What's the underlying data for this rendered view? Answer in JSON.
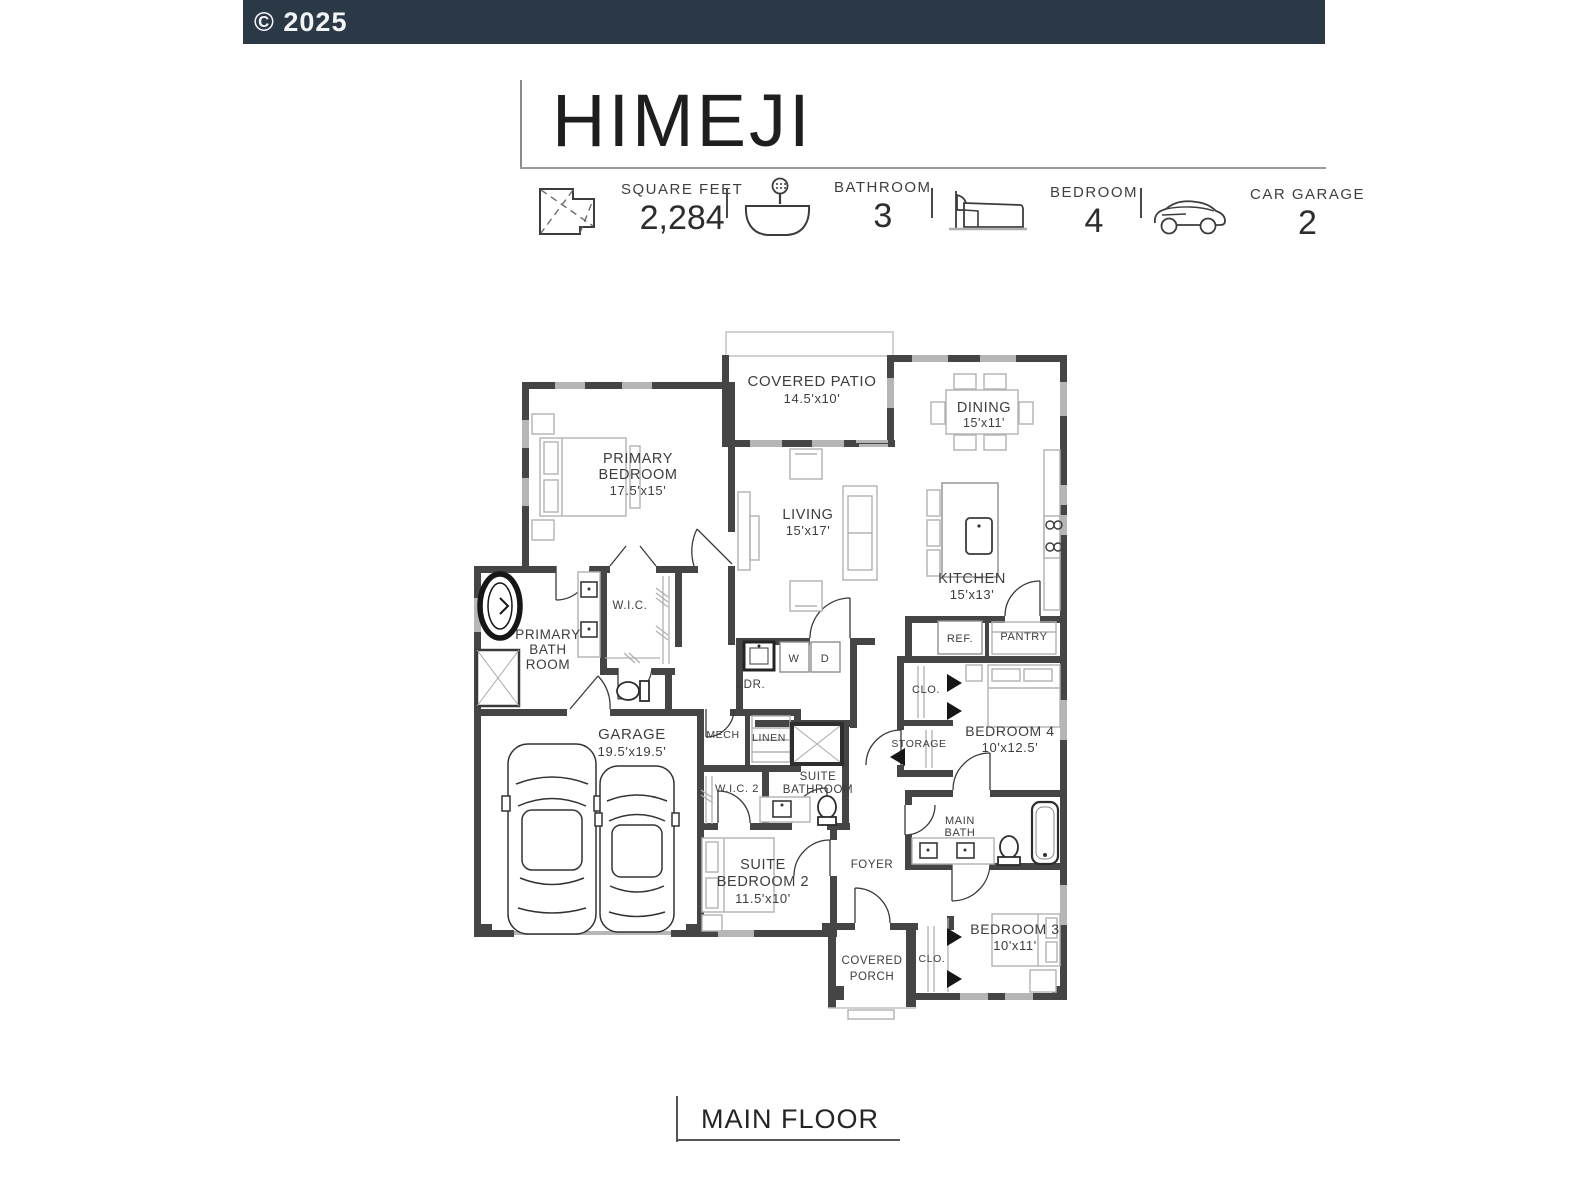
{
  "header": {
    "copyright": "© 2025"
  },
  "plan": {
    "title": "HIMEJI",
    "stats": {
      "square_feet": {
        "icon": "square-feet-icon",
        "label": "SQUARE FEET",
        "value": "2,284"
      },
      "bathroom": {
        "icon": "bathtub-icon",
        "label": "BATHROOM",
        "value": "3"
      },
      "bedroom": {
        "icon": "bed-icon",
        "label": "BEDROOM",
        "value": "4"
      },
      "car_garage": {
        "icon": "car-icon",
        "label": "CAR GARAGE",
        "value": "2"
      }
    }
  },
  "floorplan": {
    "rooms": {
      "covered_patio": {
        "l1": "COVERED PATIO",
        "dims": "14.5'x10'"
      },
      "dining": {
        "l1": "DINING",
        "dims": "15'x11'"
      },
      "primary_bedroom": {
        "l1": "PRIMARY",
        "l2": "BEDROOM",
        "dims": "17.5'x15'"
      },
      "living": {
        "l1": "LIVING",
        "dims": "15'x17'"
      },
      "kitchen": {
        "l1": "KITCHEN",
        "dims": "15'x13'"
      },
      "primary_bathroom": {
        "l1": "PRIMARY",
        "l2": "BATH",
        "l3": "ROOM"
      },
      "wic": {
        "l1": "W.I.C."
      },
      "laundry": {
        "l1": "LDR."
      },
      "washer": {
        "l1": "W"
      },
      "dryer": {
        "l1": "D"
      },
      "ref": {
        "l1": "REF."
      },
      "pantry": {
        "l1": "PANTRY"
      },
      "closet_bedroom4": {
        "l1": "CLO."
      },
      "bedroom4": {
        "l1": "BEDROOM 4",
        "dims": "10'x12.5'"
      },
      "storage": {
        "l1": "STORAGE"
      },
      "garage": {
        "l1": "GARAGE",
        "dims": "19.5'x19.5'"
      },
      "mech": {
        "l1": "MECH"
      },
      "linen": {
        "l1": "LINEN"
      },
      "wic2": {
        "l1": "W.I.C. 2"
      },
      "suite_bathroom": {
        "l1": "SUITE",
        "l2": "BATHROOM"
      },
      "suite_bedroom2": {
        "l1": "SUITE",
        "l2": "BEDROOM 2",
        "dims": "11.5'x10'"
      },
      "foyer": {
        "l1": "FOYER"
      },
      "main_bath": {
        "l1": "MAIN",
        "l2": "BATH"
      },
      "bedroom3": {
        "l1": "BEDROOM 3",
        "dims": "10'x11'"
      },
      "closet_bedroom3": {
        "l1": "CLO."
      },
      "covered_porch": {
        "l1": "COVERED",
        "l2": "PORCH"
      }
    }
  },
  "footer": {
    "label": "MAIN FLOOR"
  },
  "colors": {
    "header_bar": "#2b3947",
    "wall": "#454545",
    "label_text": "#3d3d3d"
  }
}
